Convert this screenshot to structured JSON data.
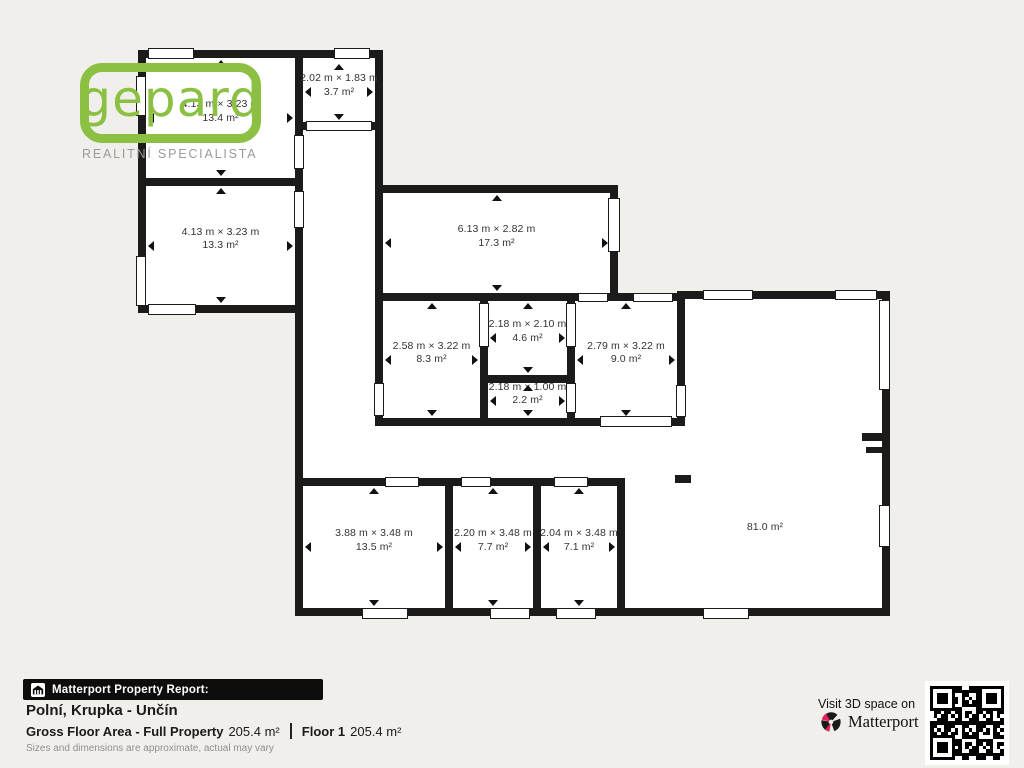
{
  "logo": {
    "name": "gepard",
    "subtitle": "REALITNÍ SPECIALISTA",
    "accent_green": "#8cc043"
  },
  "rooms": [
    {
      "dims": "4.13 m × 3.23 m",
      "area": "13.4 m²"
    },
    {
      "dims": "2.02 m × 1.83 m",
      "area": "3.7 m²"
    },
    {
      "dims": "4.13 m × 3.23 m",
      "area": "13.3 m²"
    },
    {
      "dims": "6.13 m × 2.82 m",
      "area": "17.3 m²"
    },
    {
      "dims": "2.58 m × 3.22 m",
      "area": "8.3 m²"
    },
    {
      "dims": "2.18 m × 2.10 m",
      "area": "4.6 m²"
    },
    {
      "dims": "2.79 m × 3.22 m",
      "area": "9.0 m²"
    },
    {
      "dims": "2.18 m × 1.00 m",
      "area": "2.2 m²"
    },
    {
      "dims": "3.88 m × 3.48 m",
      "area": "13.5 m²"
    },
    {
      "dims": "2.20 m × 3.48 m",
      "area": "7.7 m²"
    },
    {
      "dims": "2.04 m × 3.48 m",
      "area": "7.1 m²"
    },
    {
      "dims": "",
      "area": "81.0 m²"
    }
  ],
  "footer": {
    "report_label": "Matterport Property Report:",
    "address": "Polní, Krupka - Unčín",
    "gfa_label": "Gross Floor Area - Full Property",
    "gfa_value": "205.4 m²",
    "floor_label": "Floor 1",
    "floor_value": "205.4 m²",
    "disclaimer": "Sizes and dimensions are approximate, actual may vary",
    "visit_text": "Visit 3D space on",
    "brand": "Matterport",
    "brand_red": "#e81f5c"
  }
}
